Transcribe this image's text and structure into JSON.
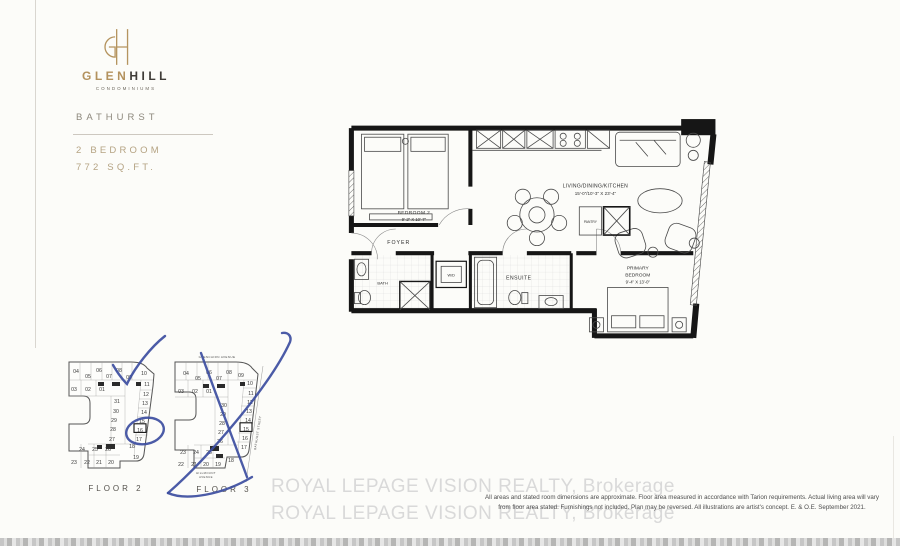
{
  "branding": {
    "monogram": "GH",
    "name_gold": "GLEN",
    "name_dark": "HILL",
    "tagline": "CONDOMINIUMS",
    "location": "BATHURST",
    "unit_type": "2 BEDROOM",
    "area": "772 SQ.FT.",
    "gold_color": "#b3925e"
  },
  "plan": {
    "labels": {
      "bedroom2": "BEDROOM 2",
      "bedroom2_dims": "9'-2\" X 10'-7\"",
      "living": "LIVING/DINING/KITCHEN",
      "living_dims": "15'-0\"/10'-3\" X 23'-4\"",
      "foyer": "FOYER",
      "bath": "BATH",
      "wd": "W/D",
      "ensuite": "ENSUITE",
      "pantry": "PANTRY",
      "primary1": "PRIMARY",
      "primary2": "BEDROOM",
      "primary_dims": "9'-4\" X 13'-0\""
    }
  },
  "keyplans": {
    "floor2": {
      "caption": "FLOOR 2",
      "highlight": "16",
      "units": [
        {
          "n": "04",
          "x": 13,
          "y": 15
        },
        {
          "n": "05",
          "x": 25,
          "y": 20
        },
        {
          "n": "06",
          "x": 36,
          "y": 14
        },
        {
          "n": "07",
          "x": 46,
          "y": 20
        },
        {
          "n": "08",
          "x": 56,
          "y": 14
        },
        {
          "n": "09",
          "x": 66,
          "y": 21
        },
        {
          "n": "10",
          "x": 81,
          "y": 17
        },
        {
          "n": "03",
          "x": 11,
          "y": 33
        },
        {
          "n": "02",
          "x": 25,
          "y": 33
        },
        {
          "n": "01",
          "x": 39,
          "y": 33
        },
        {
          "n": "11",
          "x": 84,
          "y": 28
        },
        {
          "n": "12",
          "x": 83,
          "y": 38
        },
        {
          "n": "13",
          "x": 82,
          "y": 47
        },
        {
          "n": "14",
          "x": 81,
          "y": 56
        },
        {
          "n": "15",
          "x": 79,
          "y": 65
        },
        {
          "n": "16",
          "x": 77,
          "y": 74
        },
        {
          "n": "17",
          "x": 76,
          "y": 83
        },
        {
          "n": "18",
          "x": 69,
          "y": 90
        },
        {
          "n": "19",
          "x": 73,
          "y": 101
        },
        {
          "n": "31",
          "x": 54,
          "y": 45
        },
        {
          "n": "30",
          "x": 53,
          "y": 55
        },
        {
          "n": "29",
          "x": 51,
          "y": 64
        },
        {
          "n": "28",
          "x": 50,
          "y": 73
        },
        {
          "n": "27",
          "x": 49,
          "y": 83
        },
        {
          "n": "24",
          "x": 19,
          "y": 93
        },
        {
          "n": "25",
          "x": 32,
          "y": 93
        },
        {
          "n": "26",
          "x": 45,
          "y": 93
        },
        {
          "n": "23",
          "x": 11,
          "y": 106
        },
        {
          "n": "22",
          "x": 24,
          "y": 106
        },
        {
          "n": "21",
          "x": 36,
          "y": 106
        },
        {
          "n": "20",
          "x": 48,
          "y": 106
        }
      ]
    },
    "floor3": {
      "caption": "FLOOR 3",
      "highlight": "15",
      "streets": {
        "top": "GLENCAIRN AVENUE",
        "right": "BATHURST STREET",
        "bottom1": "HILLMOUNT",
        "bottom2": "AVENUE"
      },
      "units": [
        {
          "n": "04",
          "x": 16,
          "y": 23
        },
        {
          "n": "05",
          "x": 28,
          "y": 28
        },
        {
          "n": "06",
          "x": 39,
          "y": 22
        },
        {
          "n": "07",
          "x": 49,
          "y": 28
        },
        {
          "n": "08",
          "x": 59,
          "y": 22
        },
        {
          "n": "09",
          "x": 71,
          "y": 25
        },
        {
          "n": "03",
          "x": 11,
          "y": 41
        },
        {
          "n": "02",
          "x": 25,
          "y": 41
        },
        {
          "n": "01",
          "x": 39,
          "y": 41
        },
        {
          "n": "10",
          "x": 80,
          "y": 33
        },
        {
          "n": "11",
          "x": 81,
          "y": 43
        },
        {
          "n": "12",
          "x": 80,
          "y": 52
        },
        {
          "n": "13",
          "x": 79,
          "y": 61
        },
        {
          "n": "14",
          "x": 78,
          "y": 70
        },
        {
          "n": "15",
          "x": 76,
          "y": 79
        },
        {
          "n": "16",
          "x": 75,
          "y": 88
        },
        {
          "n": "17",
          "x": 74,
          "y": 97
        },
        {
          "n": "30",
          "x": 54,
          "y": 55
        },
        {
          "n": "29",
          "x": 53,
          "y": 64
        },
        {
          "n": "28",
          "x": 52,
          "y": 73
        },
        {
          "n": "27",
          "x": 51,
          "y": 82
        },
        {
          "n": "26",
          "x": 50,
          "y": 91
        },
        {
          "n": "23",
          "x": 13,
          "y": 102
        },
        {
          "n": "24",
          "x": 26,
          "y": 102
        },
        {
          "n": "25",
          "x": 39,
          "y": 102
        },
        {
          "n": "22",
          "x": 11,
          "y": 114
        },
        {
          "n": "21",
          "x": 24,
          "y": 114
        },
        {
          "n": "20",
          "x": 36,
          "y": 114
        },
        {
          "n": "19",
          "x": 48,
          "y": 114
        },
        {
          "n": "18",
          "x": 61,
          "y": 110
        }
      ]
    }
  },
  "annotations": {
    "pen_color": "#3c4da0",
    "marks": [
      "checkmark-above-floor-2",
      "circle-around-unit-16",
      "cross-out-floor-3"
    ]
  },
  "watermark": {
    "text": "ROYAL LEPAGE VISION REALTY, Brokerage",
    "color": "#d9d9d9"
  },
  "disclaimer": {
    "line1": "All areas and stated room dimensions are approximate. Floor area measured in accordance with Tarion requirements. Actual living area will vary",
    "line2": "from floor area stated. Furnishings not included. Plan may be reversed. All illustrations are artist's concept. E. & O.E. September 2021."
  }
}
